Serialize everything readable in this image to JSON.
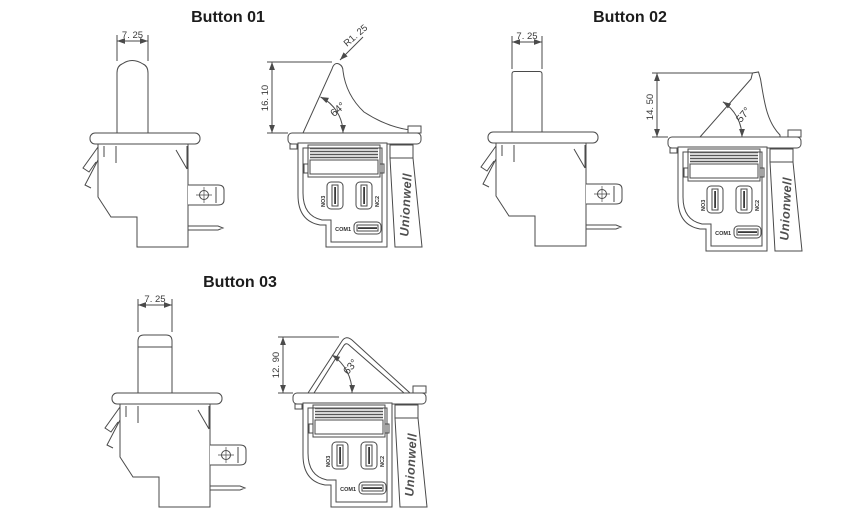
{
  "page": {
    "background": "#ffffff"
  },
  "drawing": {
    "line_color": "#4a4a4a",
    "text_color": "#3a3a3a",
    "brand_color": "#4f4f4f"
  },
  "brand": "Unionwell",
  "terminals": {
    "no": "NO3",
    "nc": "NC2",
    "com": "COM1"
  },
  "buttons": [
    {
      "id": "button-01",
      "title": "Button 01",
      "plunger_width": "7. 25",
      "lever_height": "16. 10",
      "lever_angle": "64°",
      "tip_radius": "R1. 25"
    },
    {
      "id": "button-02",
      "title": "Button 02",
      "plunger_width": "7. 25",
      "lever_height": "14. 50",
      "lever_angle": "57°"
    },
    {
      "id": "button-03",
      "title": "Button 03",
      "plunger_width": "7. 25",
      "lever_height": "12. 90",
      "lever_angle": "63°"
    }
  ]
}
